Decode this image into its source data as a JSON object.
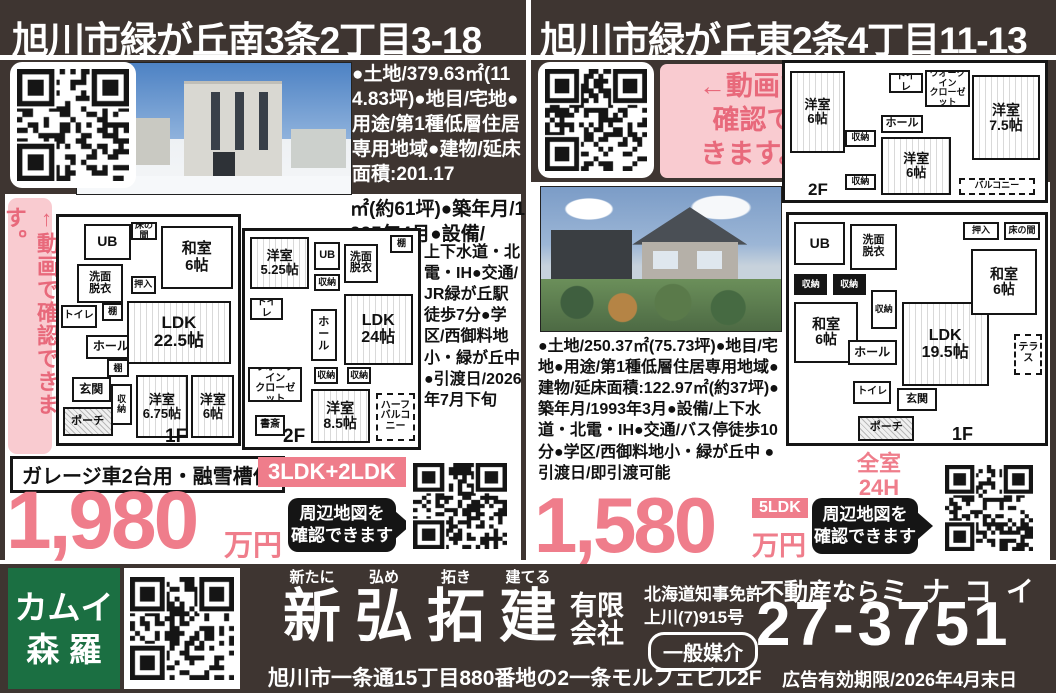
{
  "left": {
    "title": "旭川市緑が丘南3条2丁目3-18",
    "video_banner": "↑動画で確認できます。",
    "details_top": "●土地/379.63㎡(114.83坪)●地目/宅地●用途/第1種低層住居専用地域●建物/延床面積:201.17",
    "details_mid": "㎡(約61坪)●築年月/1995年4月●設備/",
    "details_side": "上下水道・北電・IH●交通/JR緑が丘駅徒歩7分●学区/西御料地小・緑が丘中●引渡日/2026年7月下旬",
    "feature_badge": "ガレージ車2台用・融雪槽付",
    "layout_badge": "3LDK+2LDK",
    "price": "1,980",
    "price_unit": "万円",
    "map_badge": "周辺地図を\n確認できます",
    "plan1f": {
      "label": "1F",
      "rooms": [
        "UB",
        "洗面\n脱衣",
        "トイレ",
        "棚",
        "ホール",
        "玄関",
        "ポーチ",
        "床の間",
        "和室\n6帖",
        "押入",
        "LDK\n22.5帖",
        "棚",
        "収納",
        "洋室\n6.75帖",
        "洋室\n6帖"
      ]
    },
    "plan2f": {
      "label": "2F",
      "rooms": [
        "洋室\n5.25帖",
        "UB",
        "収納",
        "洗面\n脱衣",
        "棚",
        "トイレ",
        "ホール",
        "LDK\n24帖",
        "ウオークイン\nクローゼット",
        "収納",
        "収納",
        "洋室\n8.5帖",
        "書斎",
        "ハーフ\nバルコニー"
      ]
    }
  },
  "right": {
    "title": "旭川市緑が丘東2条4丁目11-13",
    "video_banner": "←動画で\n確認で\nきます。",
    "details": "●土地/250.37㎡(75.73坪)●地目/宅地●用途/第1種低層住居専用地域●建物/延床面積:122.97㎡(約37坪)●築年月/1993年3月●設備/上下水道・北電・IH●交通/バス停徒歩10分●学区/西御料地小・緑が丘中 ●引渡日/即引渡可能",
    "heating_badge": "全室24H\n換気暖房",
    "layout_badge": "5LDK",
    "price": "1,580",
    "price_unit": "万円",
    "map_badge": "周辺地図を\n確認できます",
    "plan2f": {
      "label": "2F",
      "rooms": [
        "洋室\n6帖",
        "トイレ",
        "ウオークイン\nクローゼット",
        "洋室\n7.5帖",
        "ホール",
        "収納",
        "洋室\n6帖",
        "収納",
        "バルコニー"
      ]
    },
    "plan1f": {
      "label": "1F",
      "rooms": [
        "UB",
        "洗面\n脱衣",
        "収納",
        "収納",
        "和室\n6帖",
        "収納",
        "ホール",
        "トイレ",
        "玄関",
        "ポーチ",
        "LDK\n19.5帖",
        "和室\n6帖",
        "押入",
        "床の間",
        "テラス"
      ]
    }
  },
  "footer": {
    "brand_line1": "カムイ",
    "brand_line2": "森 羅",
    "furigana": [
      "新たに",
      "弘め",
      "拓き",
      "建てる"
    ],
    "name_chars": [
      "新",
      "弘",
      "拓",
      "建"
    ],
    "corp_line1": "有限",
    "corp_line2": "会社",
    "license_line1": "北海道知事免許",
    "license_line2": "上川(7)915号",
    "mediation": "一般媒介",
    "tagline": "不動産なら",
    "brand_kana": "ミナコイ",
    "phone": "27-3751",
    "expiry": "広告有効期限/2026年4月末日",
    "address": "旭川市一条通15丁目880番地の2一条モルフェビル2F"
  }
}
